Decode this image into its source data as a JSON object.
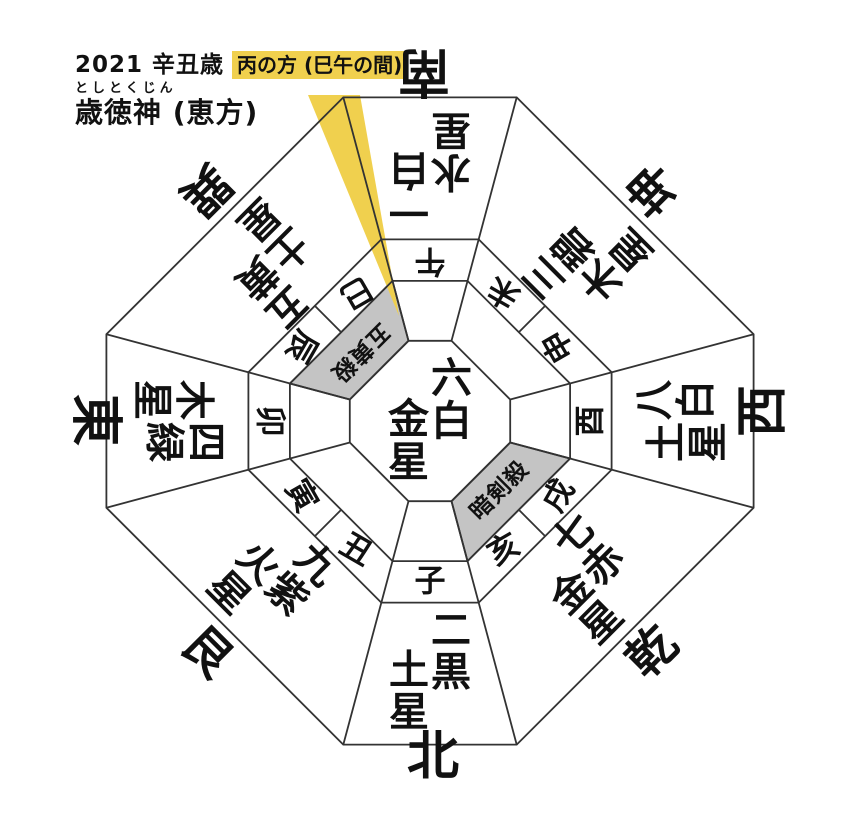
{
  "header": {
    "year": "2021 辛丑歳",
    "direction_highlight": "丙の方 (巳午の間)",
    "furigana": "としとくじん",
    "title": "歳徳神 (恵方)"
  },
  "center_star": "六白金星",
  "directions": [
    {
      "id": "south",
      "compass": "南",
      "star": "一白水星"
    },
    {
      "id": "southwest",
      "compass": "坤",
      "star": "三碧木星"
    },
    {
      "id": "west",
      "compass": "西",
      "star": "八白土星"
    },
    {
      "id": "northwest",
      "compass": "乾",
      "star": "七赤金星"
    },
    {
      "id": "north",
      "compass": "北",
      "star": "二黒土星"
    },
    {
      "id": "northeast",
      "compass": "艮",
      "star": "九紫火星"
    },
    {
      "id": "east",
      "compass": "東",
      "star": "四緑木星"
    },
    {
      "id": "southeast",
      "compass": "巽",
      "star": "五黄土星"
    }
  ],
  "zodiac": [
    {
      "id": "uma",
      "char": "午"
    },
    {
      "id": "hitsuji",
      "char": "未"
    },
    {
      "id": "saru",
      "char": "申"
    },
    {
      "id": "tori",
      "char": "酉"
    },
    {
      "id": "inu",
      "char": "戌"
    },
    {
      "id": "i",
      "char": "亥"
    },
    {
      "id": "ne",
      "char": "子"
    },
    {
      "id": "ushi",
      "char": "丑"
    },
    {
      "id": "tora",
      "char": "寅"
    },
    {
      "id": "u",
      "char": "卯"
    },
    {
      "id": "tatsu",
      "char": "辰"
    },
    {
      "id": "mi",
      "char": "巳"
    }
  ],
  "inauspicious": [
    {
      "id": "goousatsu",
      "label": "五黄殺",
      "direction": "southeast"
    },
    {
      "id": "ankensatsu",
      "label": "暗剣殺",
      "direction": "northwest"
    }
  ],
  "colors": {
    "highlight_yellow": "#F0D04E",
    "kill_gray": "#C4C4C4",
    "line": "#333333",
    "text": "#111111"
  }
}
